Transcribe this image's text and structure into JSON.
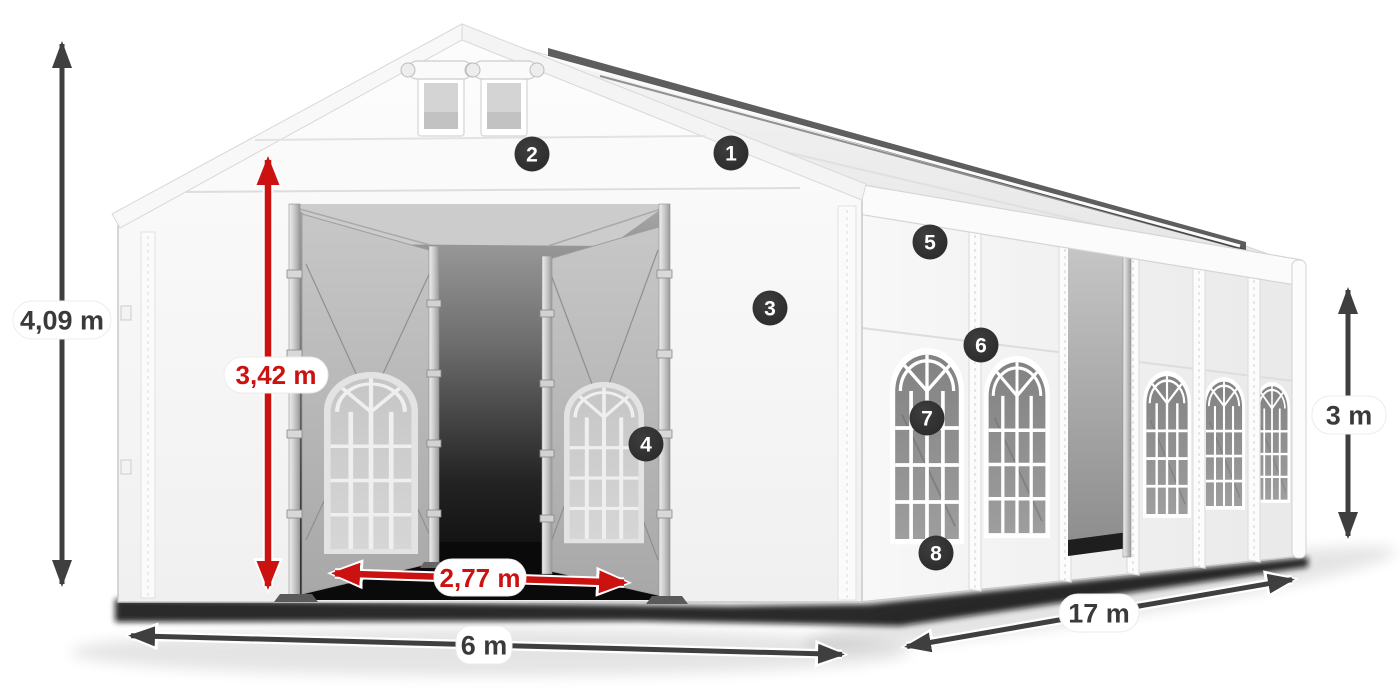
{
  "diagram": {
    "subject": "party-tent-dimension-diagram",
    "dimensions": {
      "total_height": {
        "label": "4,09 m",
        "color": "#3a3a3a",
        "orientation": "vertical-left"
      },
      "door_height": {
        "label": "3,42 m",
        "color": "#cc1111",
        "orientation": "vertical-inside-entrance"
      },
      "door_width": {
        "label": "2,77 m",
        "color": "#cc1111",
        "orientation": "horizontal-entrance"
      },
      "gable_width": {
        "label": "6 m",
        "color": "#3a3a3a",
        "orientation": "horizontal-bottom"
      },
      "length": {
        "label": "17 m",
        "color": "#3a3a3a",
        "orientation": "diagonal-bottom-right"
      },
      "side_height": {
        "label": "3 m",
        "color": "#3a3a3a",
        "orientation": "vertical-right"
      }
    },
    "markers": [
      {
        "number": "1"
      },
      {
        "number": "2"
      },
      {
        "number": "3"
      },
      {
        "number": "4"
      },
      {
        "number": "5"
      },
      {
        "number": "6"
      },
      {
        "number": "7"
      },
      {
        "number": "8"
      }
    ],
    "colors": {
      "background": "#ffffff",
      "tent_white": "#f7f7f7",
      "accent_red": "#cc1111",
      "arrow_dark": "#3f3f3f",
      "marker_bg": "#323232",
      "marker_text": "#ffffff",
      "window_glass": "#8e8e8e",
      "interior_shadow": "#0a0a0a"
    }
  }
}
